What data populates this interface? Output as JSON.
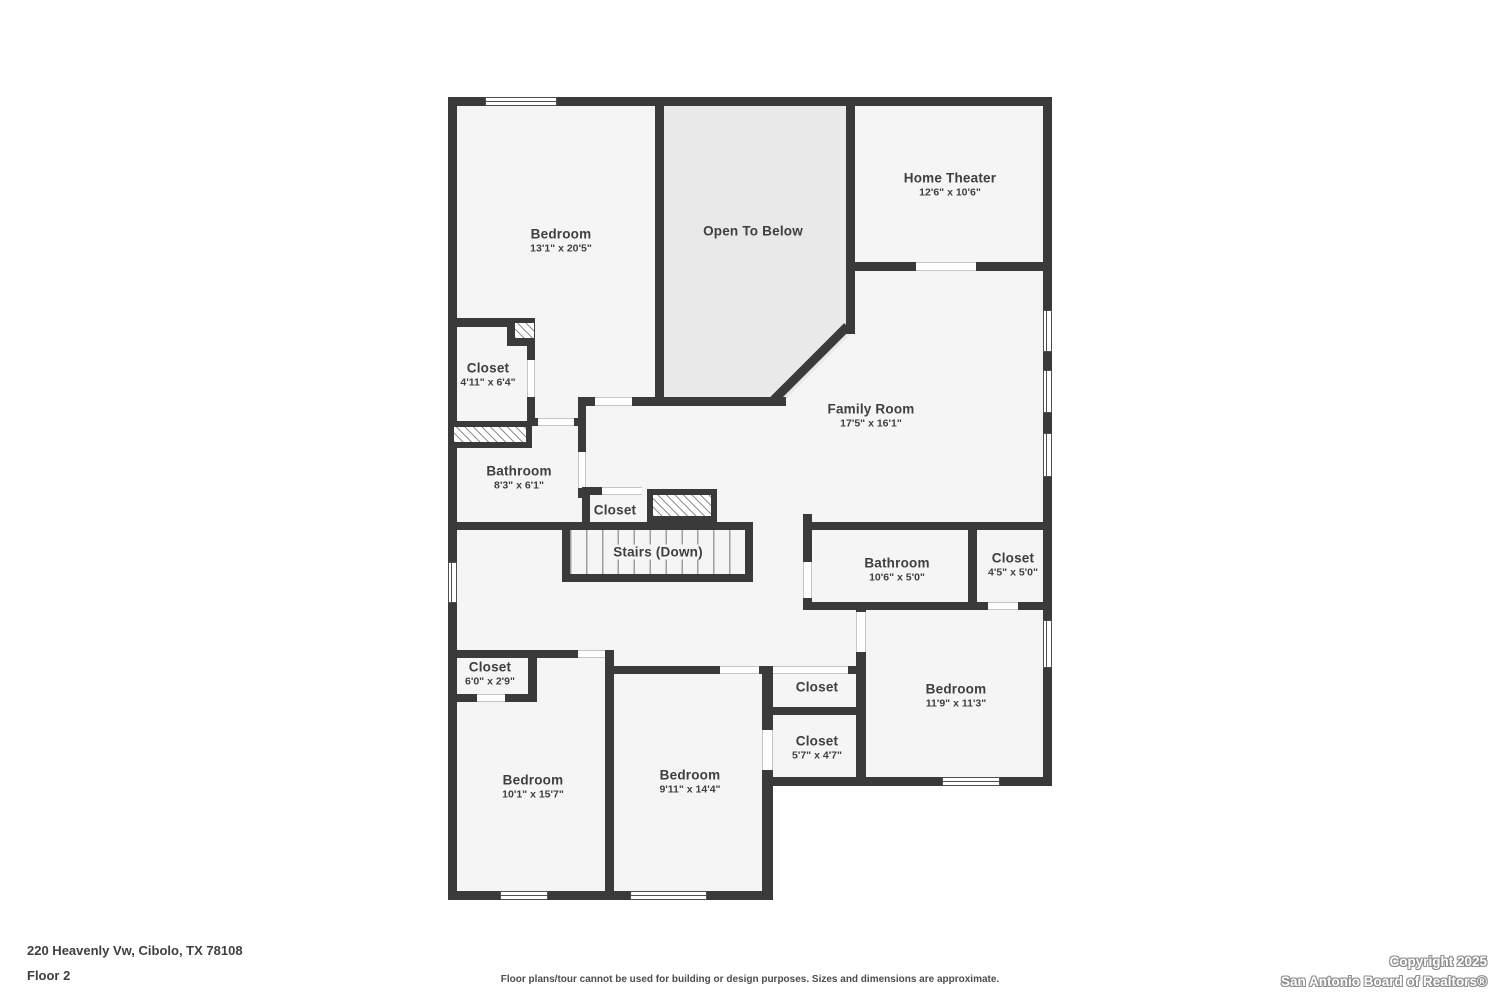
{
  "floor_plan": {
    "rooms": [
      {
        "name": "Bedroom",
        "dims": "13'1\" x 20'5\"",
        "x": 561,
        "y": 241
      },
      {
        "name": "Open To Below",
        "dims": "",
        "x": 753,
        "y": 231
      },
      {
        "name": "Home Theater",
        "dims": "12'6\" x 10'6\"",
        "x": 950,
        "y": 185
      },
      {
        "name": "Family Room",
        "dims": "17'5\" x 16'1\"",
        "x": 871,
        "y": 416
      },
      {
        "name": "Closet",
        "dims": "4'11\" x 6'4\"",
        "x": 488,
        "y": 375
      },
      {
        "name": "Bathroom",
        "dims": "8'3\" x 6'1\"",
        "x": 519,
        "y": 478
      },
      {
        "name": "Closet",
        "dims": "",
        "x": 615,
        "y": 510
      },
      {
        "name": "Stairs (Down)",
        "dims": "",
        "x": 658,
        "y": 552,
        "halo": true
      },
      {
        "name": "Bathroom",
        "dims": "10'6\" x 5'0\"",
        "x": 897,
        "y": 570
      },
      {
        "name": "Closet",
        "dims": "4'5\" x 5'0\"",
        "x": 1013,
        "y": 565
      },
      {
        "name": "Closet",
        "dims": "6'0\" x 2'9\"",
        "x": 490,
        "y": 674
      },
      {
        "name": "Closet",
        "dims": "",
        "x": 817,
        "y": 687
      },
      {
        "name": "Closet",
        "dims": "5'7\" x 4'7\"",
        "x": 817,
        "y": 748
      },
      {
        "name": "Bedroom",
        "dims": "11'9\" x 11'3\"",
        "x": 956,
        "y": 696
      },
      {
        "name": "Bedroom",
        "dims": "10'1\" x 15'7\"",
        "x": 533,
        "y": 787
      },
      {
        "name": "Bedroom",
        "dims": "9'11\" x 14'4\"",
        "x": 690,
        "y": 782
      }
    ],
    "colors": {
      "wall": "#3a3a3a",
      "room_fill": "#f5f5f5",
      "open_to_below_fill": "#e9e9e9"
    }
  },
  "footer": {
    "address": "220 Heavenly Vw, Cibolo, TX 78108",
    "floor": "Floor 2",
    "disclaimer": "Floor plans/tour cannot be used for building or design purposes. Sizes and dimensions are approximate.",
    "copyright_line1": "Copyright 2025",
    "copyright_line2": "San Antonio Board of Realtors®"
  }
}
